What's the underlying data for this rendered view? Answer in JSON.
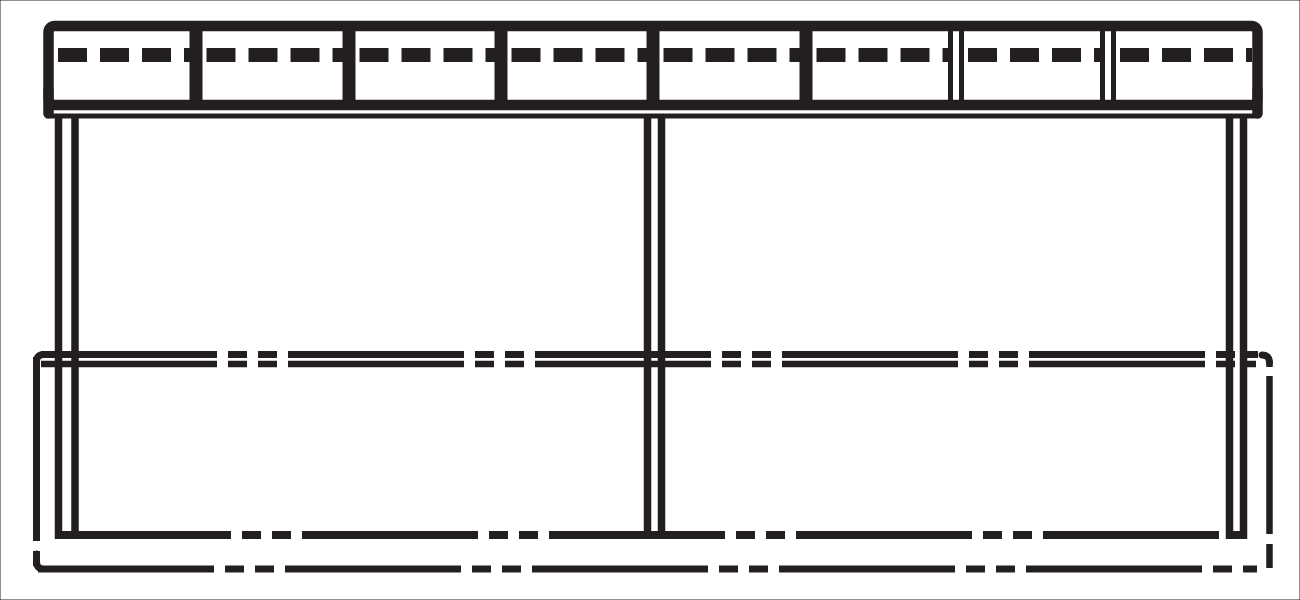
{
  "drawing": {
    "w": 1300,
    "h": 600,
    "background": "#ffffff",
    "ink": "#231f20",
    "beam": {
      "frame": {
        "x": 48.5,
        "y": 26,
        "w": 1209,
        "h": 79,
        "rx": 6,
        "sw": 10.5
      },
      "side_drops": {
        "xs": [
          48.5,
          1257.5
        ],
        "y1": 88,
        "y2": 113.5,
        "sw": 10.5
      },
      "lip": {
        "x1": 46,
        "x2": 1259,
        "y": 116,
        "sw": 5
      },
      "dividers": {
        "xs": [
          196,
          349,
          501,
          653,
          806
        ],
        "y1": 31,
        "y2": 100,
        "sw": 13
      },
      "double_dividers": {
        "xs": [
          956,
          1108
        ],
        "gap": 11,
        "y1": 31,
        "y2": 100,
        "sw": 5
      },
      "slats": {
        "y": 55,
        "sw": 14,
        "dash": "29 13",
        "inset": 4,
        "panels": [
          [
            54,
            189.5
          ],
          [
            202.5,
            342.5
          ],
          [
            355.5,
            494.5
          ],
          [
            507.5,
            646.5
          ],
          [
            659.5,
            799.5
          ],
          [
            812.5,
            948
          ],
          [
            964,
            1100
          ],
          [
            1116,
            1252
          ]
        ]
      },
      "panel_count": 8
    },
    "posts": {
      "sw": 7.5,
      "y1": 114,
      "y2": 539,
      "pairs": [
        {
          "name": "post-left",
          "lines": [
            58.5,
            75
          ]
        },
        {
          "name": "post-center",
          "lines": [
            647.5,
            661.5
          ]
        },
        {
          "name": "post-right",
          "lines": [
            1229.5,
            1243.5
          ]
        }
      ]
    },
    "phantom_dash": "176 11 19 11 19 11",
    "mid_rail": {
      "upper": {
        "y": 354.5,
        "x1": 41,
        "x2": 1258,
        "sw": 7
      },
      "lower": {
        "y": 364,
        "x1": 41,
        "x2": 1256,
        "sw": 6.5
      }
    },
    "deck_rail": {
      "y": 535,
      "x1": 55,
      "x2": 1244,
      "sw": 8
    },
    "ground": {
      "y": 569,
      "x1": 38,
      "x2": 1257,
      "sw": 7
    },
    "boundary_left": {
      "x": 36.5,
      "y1": 357,
      "y2": 566,
      "sw": 7,
      "dash": "184 10 22 10"
    },
    "boundary_right": {
      "x": 1269.5,
      "y1": 361,
      "y2": 568,
      "sw": 6.5,
      "dash": "6 9 158 10 40"
    },
    "corners": {
      "sw": 7,
      "paths": [
        {
          "name": "boundary-corner-top-left",
          "d": "M 52 354.5 L 44 354.5 Q 36.5 354.5 36.5 362 L 36.5 372"
        },
        {
          "name": "boundary-corner-top-right",
          "d": "M 1262 355 Q 1269.5 355 1269.5 363"
        },
        {
          "name": "boundary-corner-bottom-left",
          "d": "M 36.5 554 L 36.5 561.5 Q 36.5 569 44 569 L 54 569"
        }
      ]
    }
  }
}
